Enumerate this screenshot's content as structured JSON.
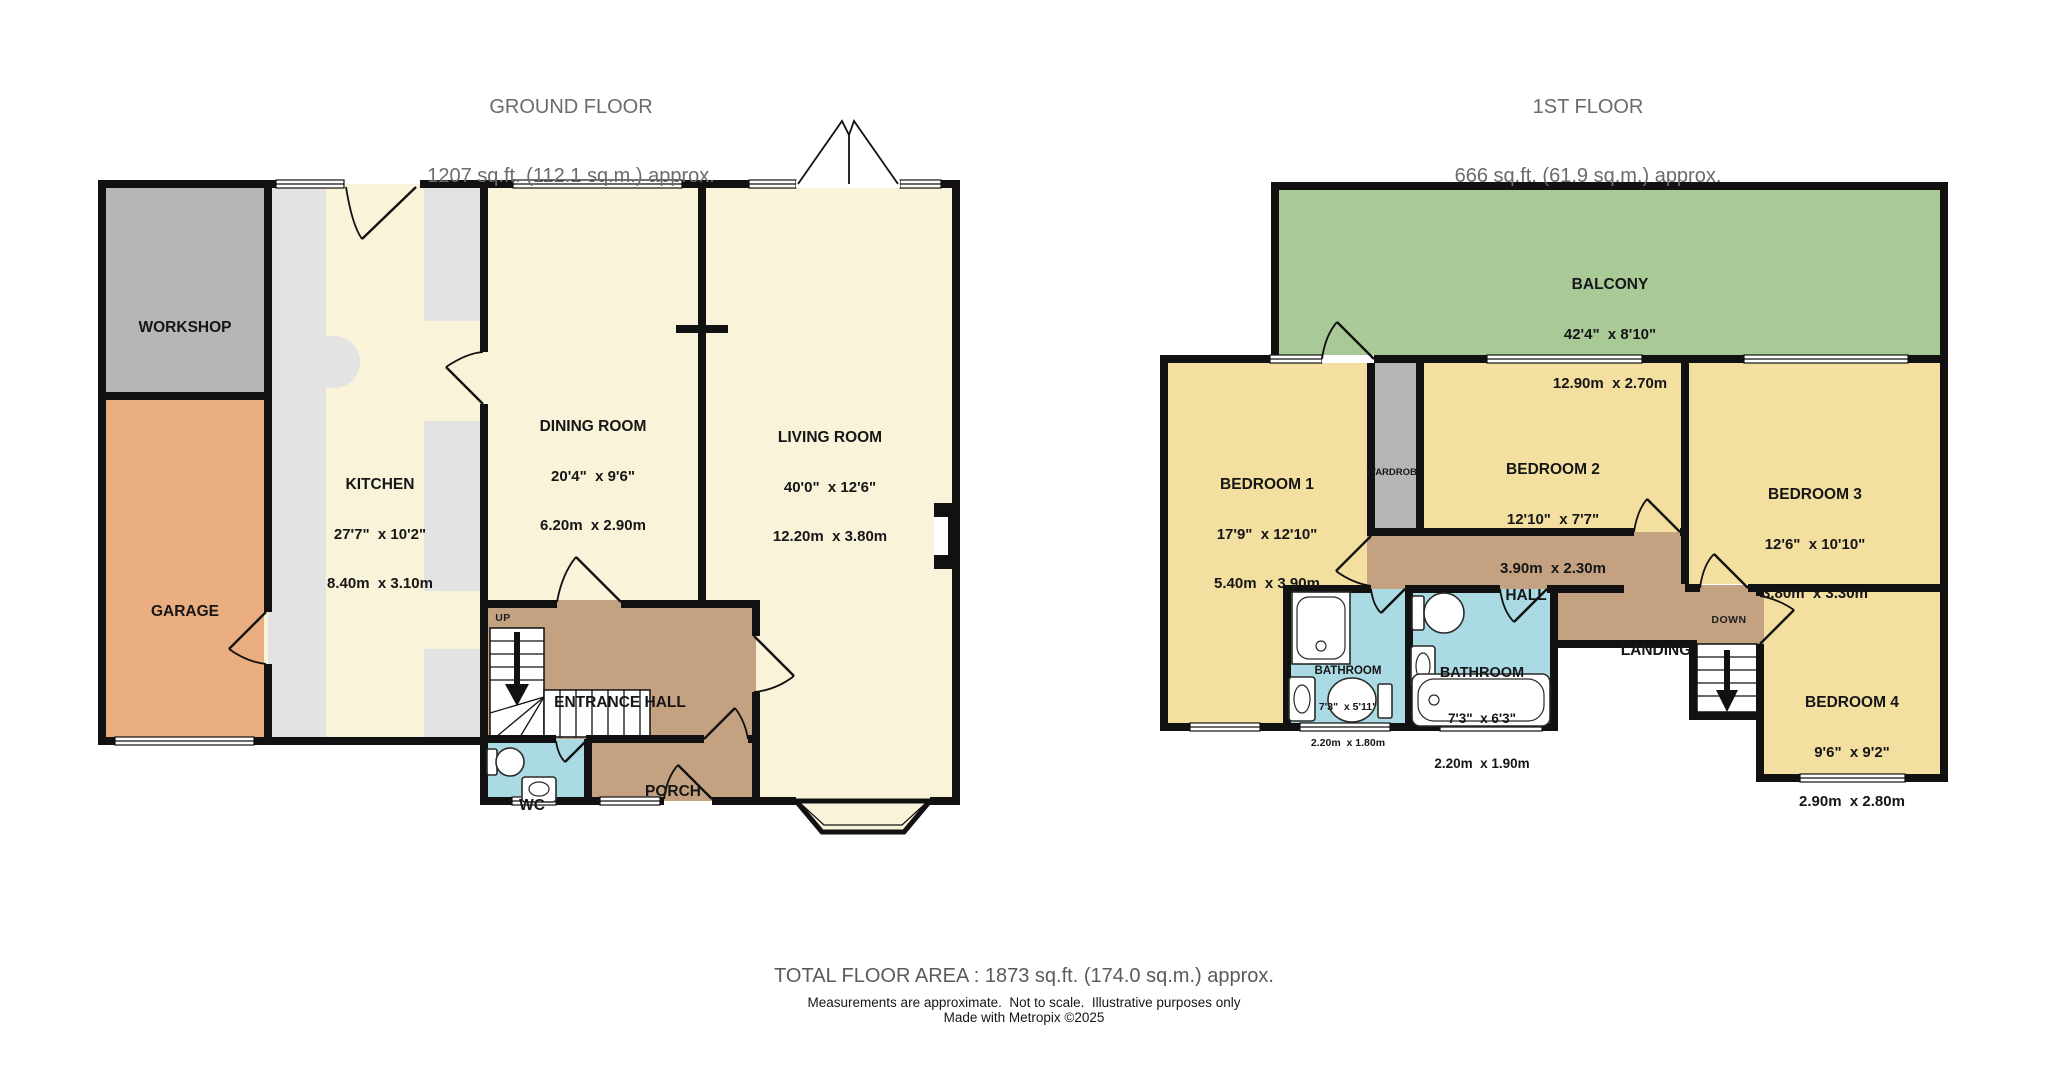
{
  "colors": {
    "wall": "#111111",
    "ground_room": "#f8f3d9",
    "bedroom": "#f3dfa0",
    "hallway_brown": "#c3a181",
    "bathroom_blue": "#aadbe4",
    "balcony_green": "#a9c997",
    "workshop_gray": "#b6b6b6",
    "counter_gray": "#e3e3e3",
    "garage_orange": "#e9ad80",
    "title_gray": "#6b6b6b"
  },
  "ground_floor": {
    "title": "GROUND FLOOR",
    "area": "1207 sq.ft. (112.1 sq.m.) approx.",
    "rooms": {
      "workshop": {
        "name": "WORKSHOP"
      },
      "garage": {
        "name": "GARAGE"
      },
      "kitchen": {
        "name": "KITCHEN",
        "imperial": "27'7\"  x 10'2\"",
        "metric": "8.40m  x 3.10m"
      },
      "dining_room": {
        "name": "DINING ROOM",
        "imperial": "20'4\"  x 9'6\"",
        "metric": "6.20m  x 2.90m"
      },
      "living_room": {
        "name": "LIVING ROOM",
        "imperial": "40'0\"  x 12'6\"",
        "metric": "12.20m  x 3.80m"
      },
      "entrance_hall": {
        "name": "ENTRANCE HALL"
      },
      "wc": {
        "name": "WC"
      },
      "porch": {
        "name": "PORCH"
      },
      "up_label": "UP"
    }
  },
  "first_floor": {
    "title": "1ST FLOOR",
    "area": "666 sq.ft. (61.9 sq.m.) approx.",
    "rooms": {
      "balcony": {
        "name": "BALCONY",
        "imperial": "42'4\"  x 8'10\"",
        "metric": "12.90m  x 2.70m"
      },
      "bedroom1": {
        "name": "BEDROOM 1",
        "imperial": "17'9\"  x 12'10\"",
        "metric": "5.40m  x 3.90m"
      },
      "wardrobe": {
        "name": "WARDROBE"
      },
      "bedroom2": {
        "name": "BEDROOM 2",
        "imperial": "12'10\"  x 7'7\"",
        "metric": "3.90m  x 2.30m"
      },
      "bedroom3": {
        "name": "BEDROOM 3",
        "imperial": "12'6\"  x 10'10\"",
        "metric": "3.80m  x 3.30m"
      },
      "hall": {
        "name": "HALL"
      },
      "landing": {
        "name": "LANDING"
      },
      "down_label": "DOWN",
      "bathroom1": {
        "name": "BATHROOM",
        "imperial": "7'3\"  x 5'11\"",
        "metric": "2.20m  x 1.80m"
      },
      "bathroom2": {
        "name": "BATHROOM",
        "imperial": "7'3\"  x 6'3\"",
        "metric": "2.20m  x 1.90m"
      },
      "bedroom4": {
        "name": "BEDROOM 4",
        "imperial": "9'6\"  x 9'2\"",
        "metric": "2.90m  x 2.80m"
      }
    }
  },
  "footer": {
    "total": "TOTAL FLOOR AREA : 1873 sq.ft. (174.0 sq.m.) approx.",
    "disclaimer": "Measurements are approximate.  Not to scale.  Illustrative purposes only",
    "credit": "Made with Metropix ©2025"
  }
}
